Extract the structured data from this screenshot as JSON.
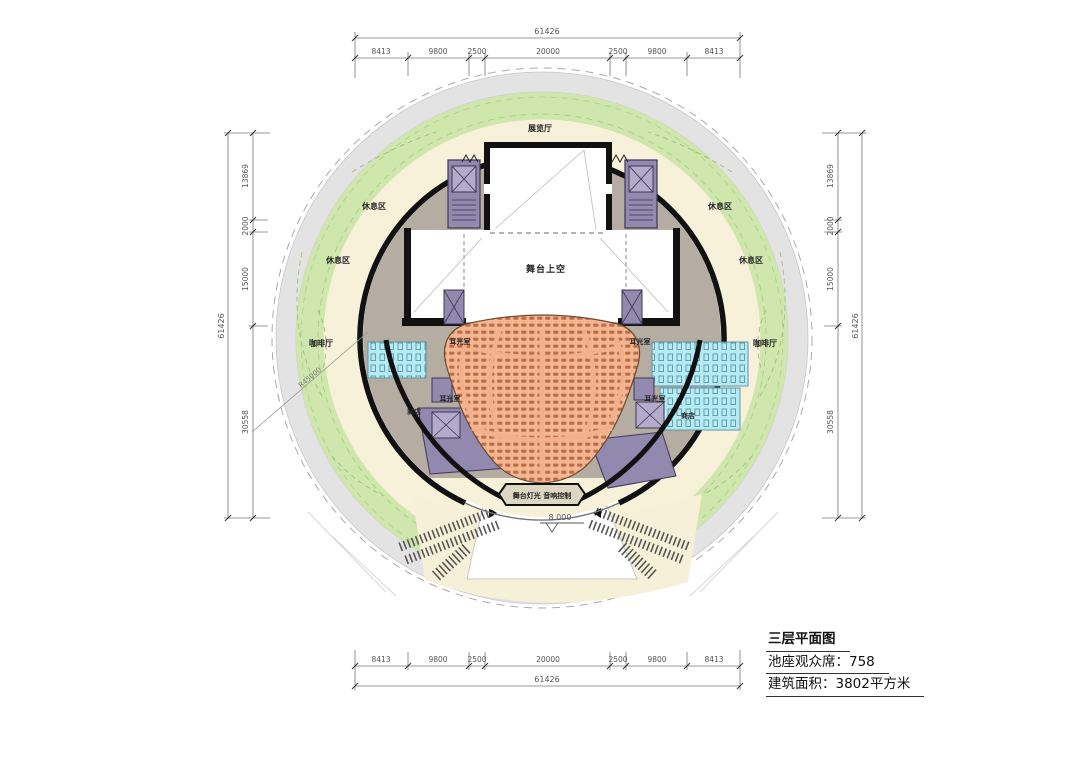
{
  "title_block": {
    "plan_title": "三层平面图",
    "seats_line": "池座观众席：758",
    "area_line": "建筑面积：3802平方米"
  },
  "dimensions": {
    "total": "61426",
    "h_segments": [
      "8413",
      "9800",
      "2500",
      "20000",
      "2500",
      "9800",
      "8413"
    ],
    "v_segments": [
      "13869",
      "2000",
      "15000",
      "30558"
    ],
    "radius_annotation": "R45000",
    "elevation_marker": "8.000"
  },
  "plan_labels": {
    "gallery_top": "展览厅",
    "stage_void": "舞台上空",
    "lounge": "休息区",
    "cafe": "咖啡厅",
    "shop": "商店",
    "ear_light_room": "耳光室",
    "control_booth": "舞台灯光 音响控制"
  },
  "colors": {
    "ring_walkway": "#e3e3e3",
    "ring_garden": "#cfe7ad",
    "ring_foyer": "#f8f1da",
    "interior_floor": "#b5aca2",
    "core_purple": "#9189ae",
    "washroom_cyan": "#b5ecf4",
    "seating_salmon": "#f2b08c",
    "seat_mark": "#bb6f49",
    "wall_black": "#111111"
  }
}
